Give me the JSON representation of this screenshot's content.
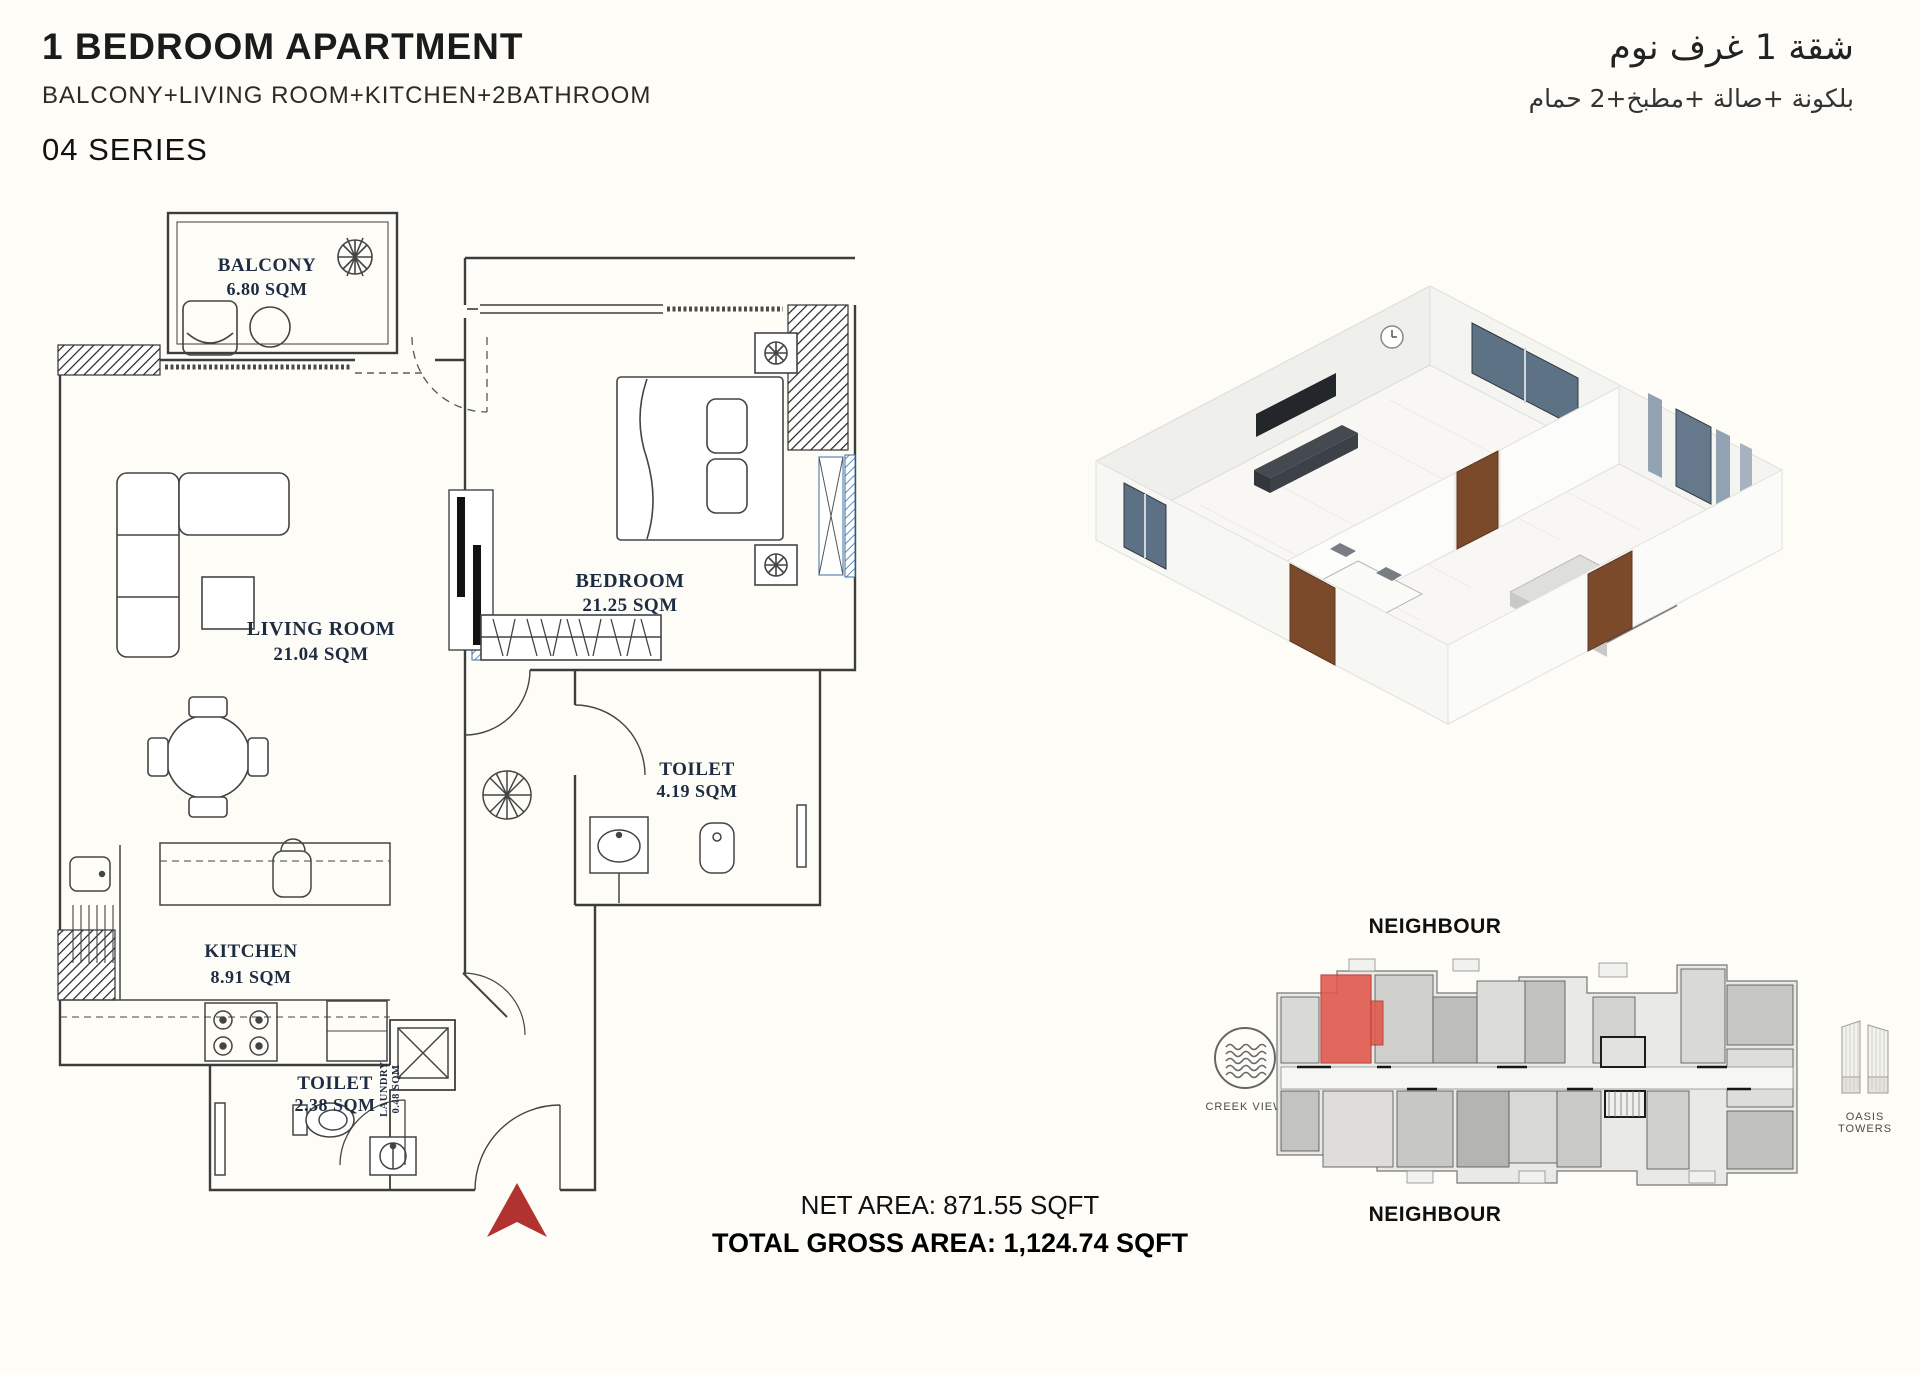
{
  "header": {
    "title": "1 BEDROOM APARTMENT",
    "subtitle": "BALCONY+LIVING ROOM+KITCHEN+2BATHROOM",
    "series": "04 SERIES",
    "title_ar": "شقة 1 غرف نوم",
    "subtitle_ar": "بلكونة +صالة +مطبخ+2 حمام"
  },
  "floor_plan": {
    "rooms": [
      {
        "name": "BALCONY",
        "area": "6.80 SQM"
      },
      {
        "name": "LIVING ROOM",
        "area": "21.04 SQM"
      },
      {
        "name": "BEDROOM",
        "area": "21.25 SQM"
      },
      {
        "name": "TOILET",
        "area": "4.19 SQM"
      },
      {
        "name": "KITCHEN",
        "area": "8.91 SQM"
      },
      {
        "name": "LAUNDRY",
        "area": "0.48 SQM"
      },
      {
        "name": "TOILET",
        "area": "2.38 SQM"
      }
    ]
  },
  "key_plate": {
    "neighbour_top": "NEIGHBOUR",
    "neighbour_bottom": "NEIGHBOUR",
    "creek_view_label": "CREEK VIEW",
    "oasis_towers_label": "OASIS TOWERS"
  },
  "areas": {
    "net": "NET AREA: 871.55 SQFT",
    "gross": "TOTAL GROSS AREA: 1,124.74 SQFT"
  },
  "colors": {
    "entrance_arrow": "#b23230",
    "highlight_unit": "#e2574c",
    "window_hatch": "#5b8fc9",
    "plan_line": "#3d3d3d"
  }
}
